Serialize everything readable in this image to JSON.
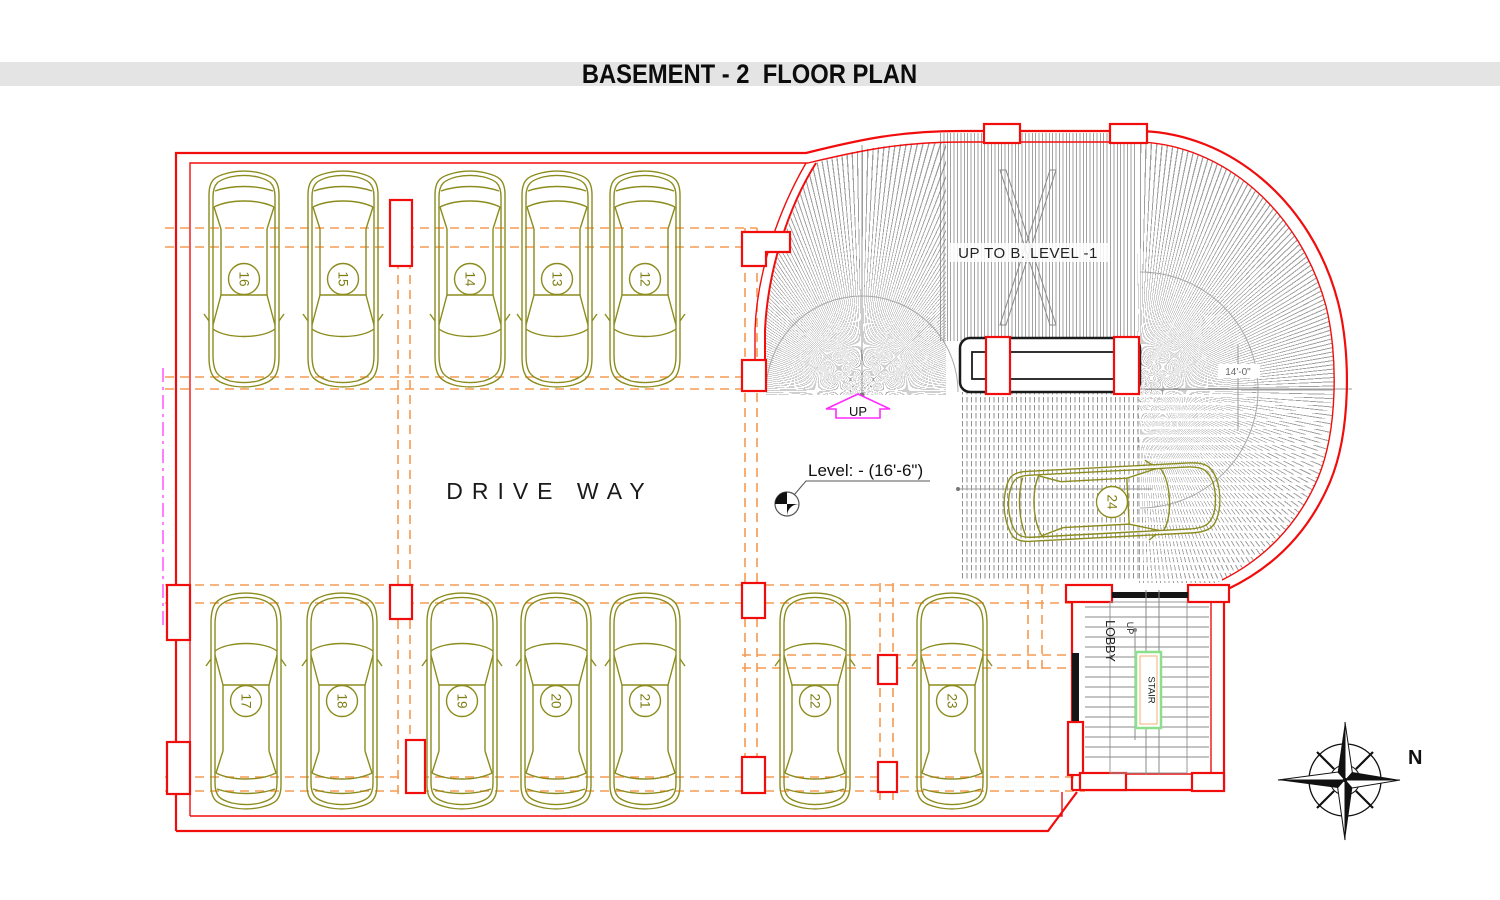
{
  "title": "BASEMENT - 2  FLOOR PLAN",
  "plan": {
    "drive_way_label": "DRIVE WAY",
    "ramp_label": "UP TO B. LEVEL -1",
    "level_note": "Level: - (16'-6\")",
    "ramp_up_arrow_label": "UP",
    "ramp_lane_width": "14'-0\"",
    "lobby_label": "LOBBY",
    "stair_label": "STAIR",
    "stair_up_label": "UP",
    "north_label": "N"
  },
  "parking": {
    "top_row": [
      "16",
      "15",
      "14",
      "13",
      "12"
    ],
    "bottom_row": [
      "17",
      "18",
      "19",
      "20",
      "21",
      "22",
      "23"
    ],
    "ramp_car": "24"
  },
  "colors": {
    "boundary_red": "#f20d0d",
    "grid_orange": "#f79a50",
    "car_olive": "#8c8c1e",
    "hatch_gray": "#8a8a8a",
    "ramp_arrow_magenta": "#ff2bff",
    "stair_box_green": "#8ce08c",
    "title_band_bg": "#e4e4e4"
  }
}
